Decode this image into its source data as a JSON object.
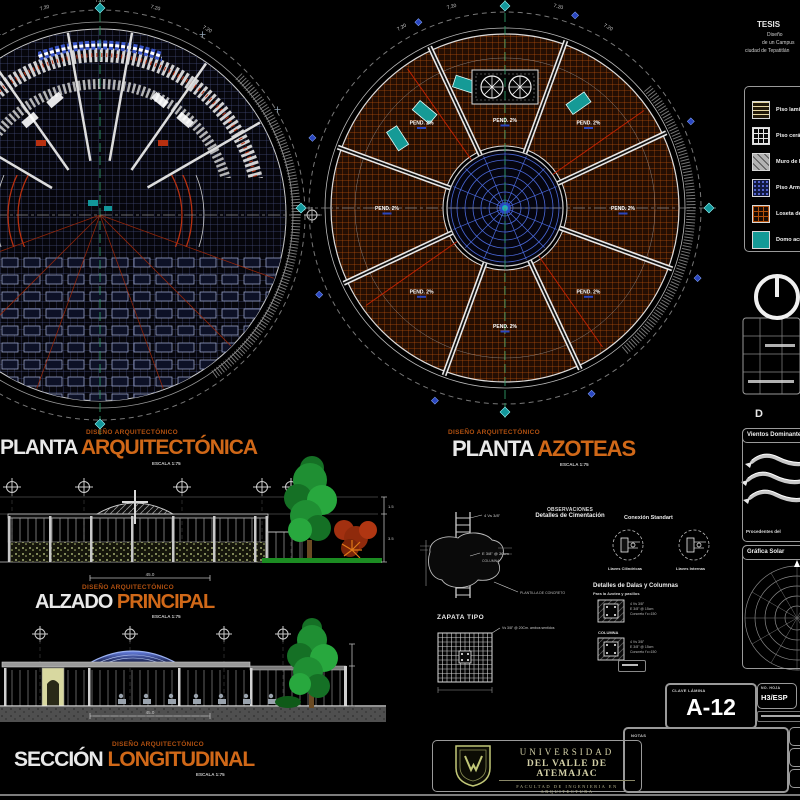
{
  "colors": {
    "accent_orange": "#d06818",
    "overline_orange": "#b05010",
    "teal": "#12969a",
    "grid_blue": "#4a5383",
    "hatch_orange": "#b4500a",
    "dome_web_blue": "#4a68d8",
    "red_line": "#b83010",
    "centerline_green": "#2f9a66"
  },
  "tesis": {
    "title": "TESIS",
    "line1": "Diseño",
    "line2": "de un Campus",
    "line3": "ciudad de Tepatitlán"
  },
  "legend": {
    "items": [
      {
        "name": "piso-laminado",
        "label": "Piso laminado"
      },
      {
        "name": "piso-ceramico",
        "label": "Piso cerámico"
      },
      {
        "name": "muro-block",
        "label": "Muro de block"
      },
      {
        "name": "piso-armado",
        "label": "Piso Armado"
      },
      {
        "name": "loseta-barro",
        "label": "Loseta de barro"
      },
      {
        "name": "domo-acrilico",
        "label": "Domo acrílico"
      }
    ]
  },
  "titles": {
    "overline": "DISEÑO ARQUITECTÓNICO",
    "scale": "ESCALA 1:75",
    "planta1_white": "PLANTA",
    "planta1_orange": "ARQUITECTÓNICA",
    "planta2_white": "PLANTA",
    "planta2_orange": "AZOTEAS",
    "alzado_white": "ALZADO",
    "alzado_orange": "PRINCIPAL",
    "seccion_white": "SECCIÓN",
    "seccion_orange": "LONGITUDINAL"
  },
  "plans": {
    "pend": "PEND. 2%",
    "dim": "7.20"
  },
  "elev": {
    "dim_top": "1.5",
    "dim_mid": "3.5",
    "dim_bottom": "45.0"
  },
  "details": {
    "obs_title": "OBSERVACIONES",
    "obs_sub": "Detalles de Cimentación",
    "zapata": "ZAPATA TIPO",
    "ann_varillas": "4 Vs 3/8\"",
    "ann_estribos": "E 3/8\" @ 20cm",
    "ann_columna": "COLUMNA",
    "ann_plantilla": "PLANTILLA DE CONCRETO",
    "ann_malla": "Vs 3/8\" @ 20Cm. ambos sentidos",
    "conexion_title": "Conexión Standart",
    "conexion_left": "Llaves Cilindricas",
    "conexion_right": "Llaves Internas",
    "dalas_title": "Detalles de Dalas y Columnas",
    "dalas_sub": "Para la Azotea y pasillos",
    "columna_label": "COLUMNA",
    "nota_a": "4 Vs 3/8\"",
    "nota_b": "E 3/8\" @ 15cm",
    "nota_c": "Concreto f'c=150"
  },
  "right_panel": {
    "vientos_title": "Vientos Dominantes",
    "vientos_caption": "Procedentes del ",
    "grafica_title": "Gráfica Solar",
    "d_heading": "D"
  },
  "titleblock": {
    "clave_label": "CLAVE LÁMINA",
    "clave_value": "A-12",
    "hoja_label": "NO. HOJA",
    "hoja_value": "H3/ESP",
    "notas_label": "NOTAS"
  },
  "logo": {
    "line1": "UNIVERSIDAD",
    "line2": "DEL VALLE DE ATEMAJAC",
    "line3": "FACULTAD DE INGENIERIA EN ARQUITECTURA"
  }
}
